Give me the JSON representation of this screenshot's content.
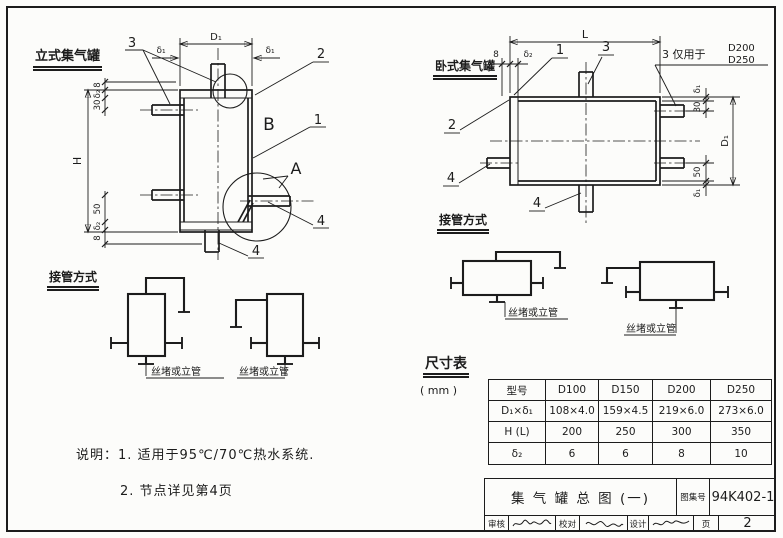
{
  "page": {
    "ink": "#1c1c1c",
    "paper": "#fcfcfa"
  },
  "left_view": {
    "title": "立式集气罐",
    "callout_1": "1",
    "callout_2": "2",
    "callout_3": "3",
    "callout_4a": "4",
    "callout_4b": "4",
    "detail_a": "A",
    "detail_b": "B",
    "dim_D1": "D₁",
    "dim_delta1_left": "δ₁",
    "dim_delta1_right": "δ₁",
    "dim_H": "H",
    "dim_top_8": "8",
    "dim_top_delta2": "δ₂",
    "dim_top_30": "30",
    "dim_bot_50": "50",
    "dim_bot_delta2": "δ₂",
    "dim_bot_8": "8"
  },
  "right_view": {
    "title": "卧式集气罐",
    "callout_1": "1",
    "callout_2": "2",
    "callout_3": "3",
    "callout_4a": "4",
    "callout_4b": "4",
    "note_only_for": "3 仅用于",
    "note_d200": "D200",
    "note_d250": "D250",
    "dim_L": "L",
    "dim_8": "8",
    "dim_delta2": "δ₂",
    "dim_delta1_top": "δ₁",
    "dim_30": "30",
    "dim_D1": "D₁",
    "dim_50": "50",
    "dim_delta1_bot": "δ₁"
  },
  "left_schematics": {
    "title": "接管方式",
    "label_1": "丝堵或立管",
    "label_2": "丝堵或立管"
  },
  "right_schematics": {
    "title": "接管方式",
    "label_1": "丝堵或立管",
    "label_2": "丝堵或立管"
  },
  "notes": {
    "line1": "说明：1. 适用于95℃/70℃热水系统.",
    "line2": "2. 节点详见第4页"
  },
  "size_table": {
    "title": "尺寸表",
    "unit": "( mm )",
    "headers": [
      "型号",
      "D100",
      "D150",
      "D200",
      "D250"
    ],
    "rows": [
      {
        "label": "D₁×δ₁",
        "values": [
          "108×4.0",
          "159×4.5",
          "219×6.0",
          "273×6.0"
        ]
      },
      {
        "label": "H (L)",
        "values": [
          "200",
          "250",
          "300",
          "350"
        ]
      },
      {
        "label": "δ₂",
        "values": [
          "6",
          "6",
          "8",
          "10"
        ]
      }
    ]
  },
  "title_block": {
    "drawing_title": "集 气 罐 总 图 (一)",
    "atlas_label": "图集号",
    "atlas_no": "94K402-1",
    "review_label": "审核",
    "check_label": "校对",
    "design_label": "设计",
    "page_label": "页",
    "page_no": "2"
  }
}
